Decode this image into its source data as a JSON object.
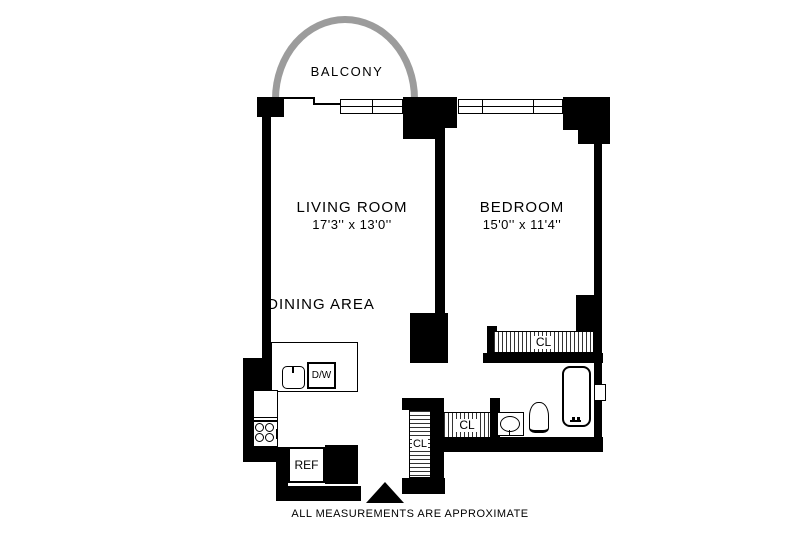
{
  "floorplan": {
    "balcony": {
      "label": "BALCONY"
    },
    "living_room": {
      "label": "LIVING ROOM",
      "dimensions": "17'3'' x 13'0''"
    },
    "dining_area": {
      "label": "DINING AREA"
    },
    "bedroom": {
      "label": "BEDROOM",
      "dimensions": "15'0'' x 11'4''"
    },
    "closets": {
      "bedroom_closet": "CL",
      "hall_closet": "CL",
      "entry_closet": "CL"
    },
    "kitchen": {
      "dishwasher": "D/W",
      "refrigerator": "REF"
    },
    "footer": {
      "disclaimer": "ALL MEASUREMENTS ARE APPROXIMATE"
    },
    "colors": {
      "wall": "#000000",
      "balcony_arc": "#9c9c9c",
      "background": "#ffffff",
      "text": "#000000"
    }
  }
}
